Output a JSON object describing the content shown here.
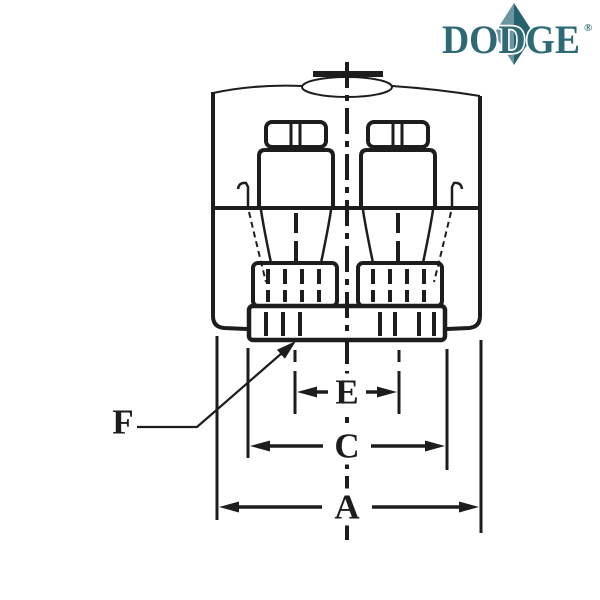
{
  "logo": {
    "text": "DODGE",
    "registered_mark": "®",
    "letter_color": "#2d6a75",
    "diamond_left_color": "#6b95a0",
    "diamond_right_color": "#27616d"
  },
  "diagram": {
    "line_color": "#1d1d1d",
    "labels": {
      "a": "A",
      "c": "C",
      "e": "E",
      "f": "F"
    }
  }
}
